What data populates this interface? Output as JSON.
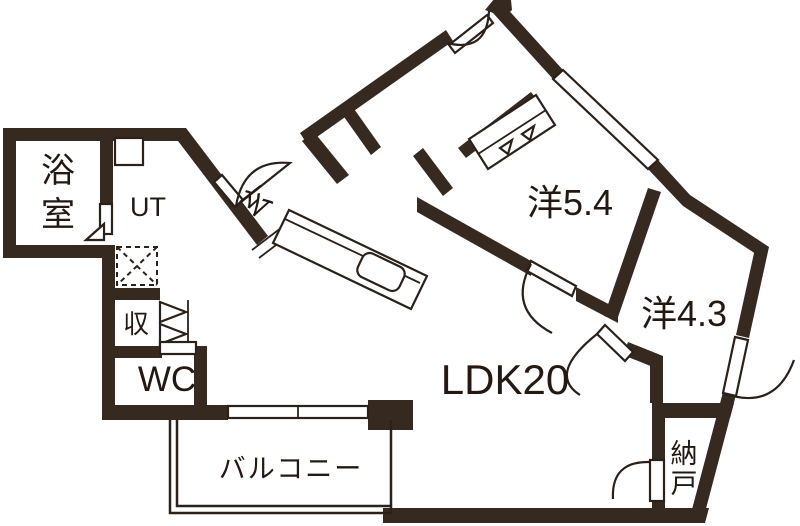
{
  "floorplan": {
    "background": "#ffffff",
    "wall_color": "#362a20",
    "line_color": "#2b211b",
    "labels": {
      "bathroom": {
        "full": "浴室",
        "chars": [
          "浴",
          "室"
        ]
      },
      "utility": "UT",
      "entrance": "玄",
      "storage": "収",
      "toilet": "WC",
      "western_room_large": "洋5.4",
      "western_room_small": "洋4.3",
      "ldk": "LDK20",
      "balcony": "バルコニー",
      "storeroom": {
        "full": "納戸",
        "chars": [
          "納",
          "戸"
        ]
      }
    }
  }
}
